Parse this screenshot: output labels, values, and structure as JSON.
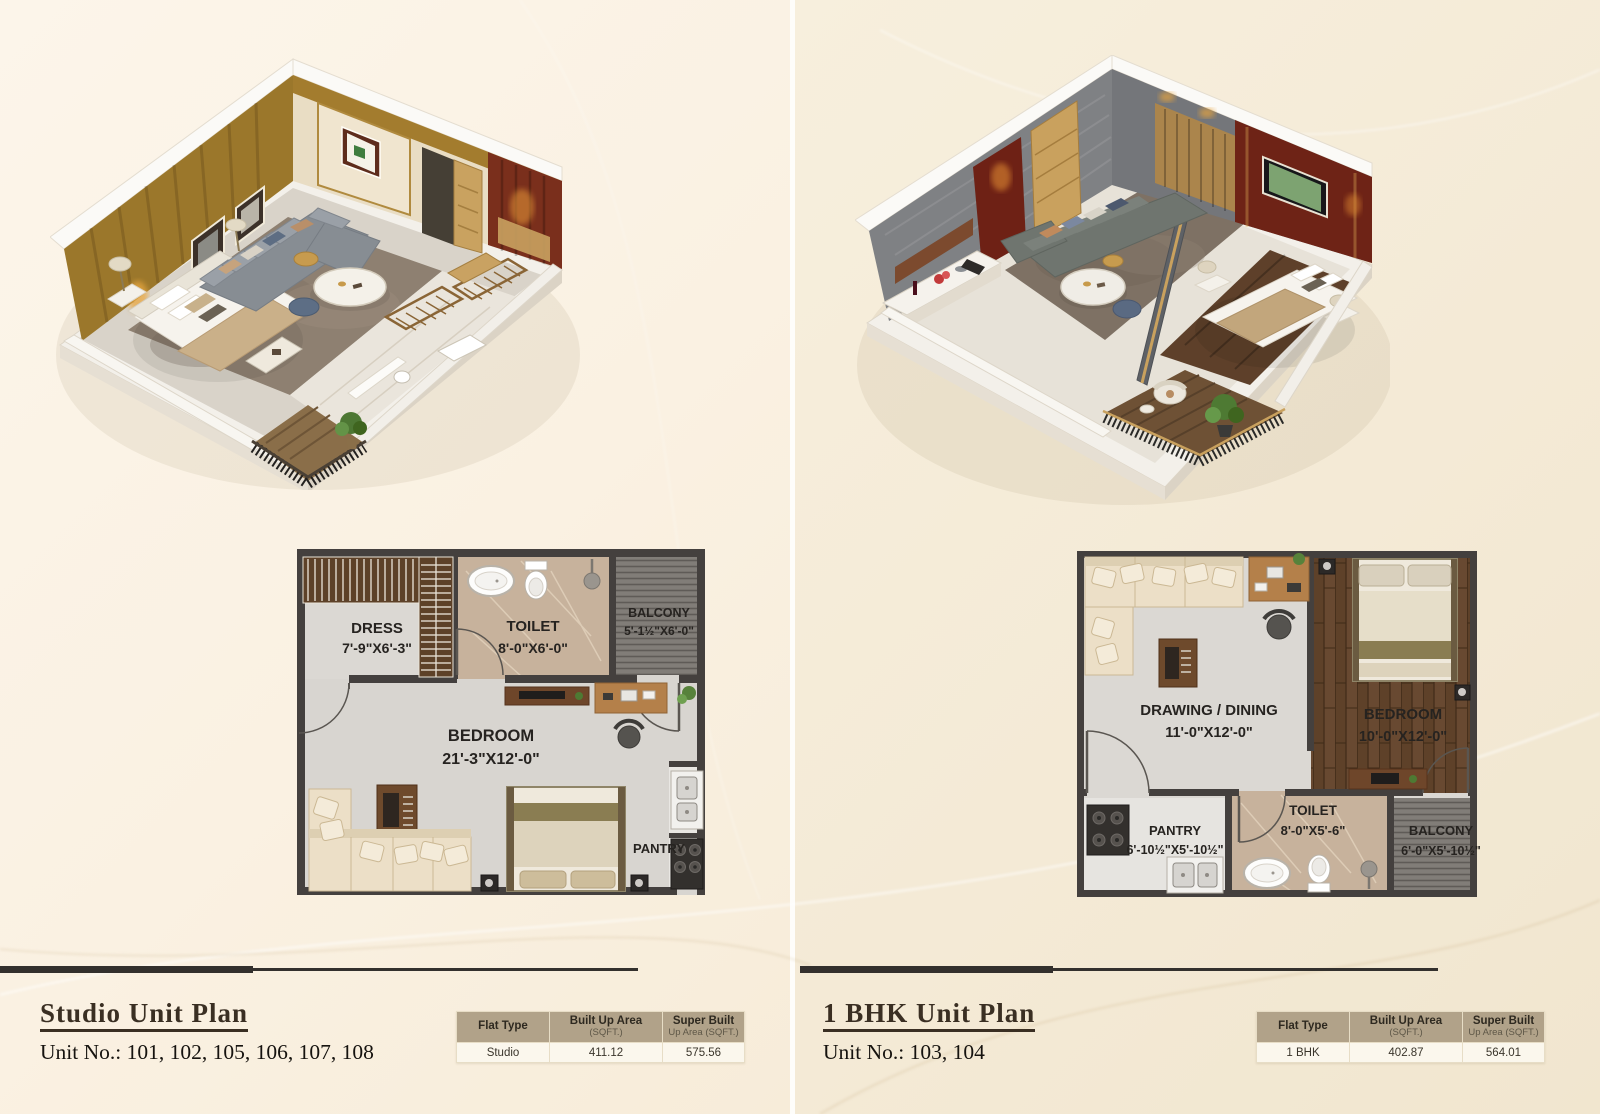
{
  "left": {
    "title": "Studio Unit Plan",
    "unit_no": "Unit No.: 101, 102, 105, 106, 107, 108",
    "plan": {
      "dress_name": "DRESS",
      "dress_dim": "7'-9\"X6'-3\"",
      "toilet_name": "TOILET",
      "toilet_dim": "8'-0\"X6'-0\"",
      "balcony_name": "BALCONY",
      "balcony_dim": "5'-1½\"X6'-0\"",
      "bedroom_name": "BEDROOM",
      "bedroom_dim": "21'-3\"X12'-0\"",
      "pantry_name": "PANTRY"
    },
    "table": {
      "col1": "Flat Type",
      "col2a": "Built Up Area",
      "col2b": "(SQFT.)",
      "col3a": "Super Built",
      "col3b": "Up Area (SQFT.)",
      "flat_type": "Studio",
      "built_up": "411.12",
      "super_built": "575.56"
    }
  },
  "right": {
    "title": "1 BHK Unit Plan",
    "unit_no": "Unit No.: 103, 104",
    "plan": {
      "drawing_name": "DRAWING / DINING",
      "drawing_dim": "11'-0\"X12'-0\"",
      "bedroom_name": "BEDROOM",
      "bedroom_dim": "10'-0\"X12'-0\"",
      "pantry_name": "PANTRY",
      "pantry_dim": "6'-10½\"X5'-10½\"",
      "toilet_name": "TOILET",
      "toilet_dim": "8'-0\"X5'-6\"",
      "balcony_name": "BALCONY",
      "balcony_dim": "6'-0\"X5'-10½\""
    },
    "table": {
      "col1": "Flat Type",
      "col2a": "Built Up Area",
      "col2b": "(SQFT.)",
      "col3a": "Super Built",
      "col3b": "Up Area (SQFT.)",
      "flat_type": "1 BHK",
      "built_up": "402.87",
      "super_built": "564.01"
    }
  },
  "colors": {
    "background_left": "#faf1e2",
    "background_right": "#f4ead6",
    "wall": "#44403e",
    "title_text": "#3a2f23",
    "table_header_bg": "#b1a289",
    "table_row_bg": "#fbf7ed",
    "accent_wood": "#9b772b",
    "accent_maroon": "#6e2115"
  }
}
